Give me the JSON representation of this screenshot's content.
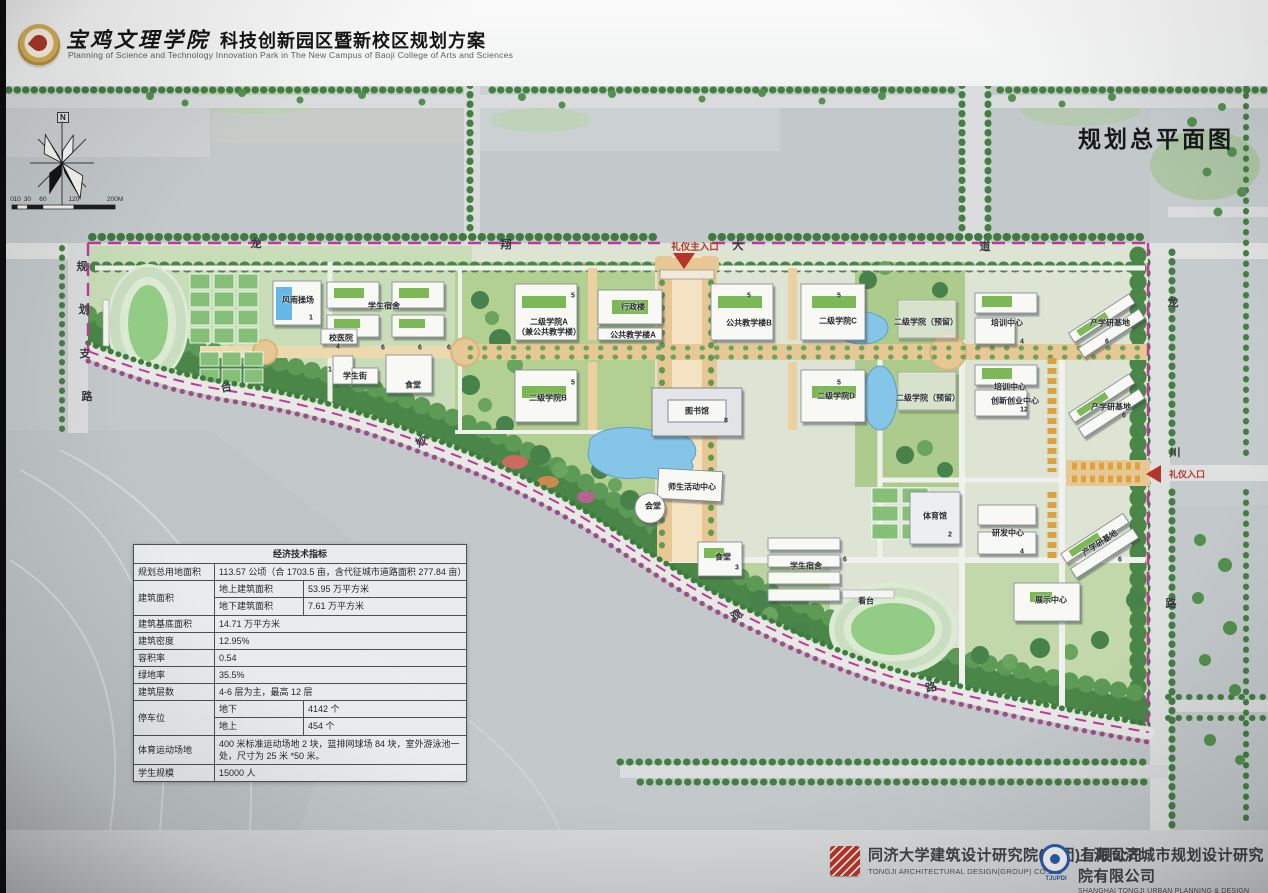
{
  "header": {
    "college_name": "宝鸡文理学院",
    "plan_title": "科技创新园区暨新校区规划方案",
    "subtitle_en": "Planning of Science and Technology Innovation Park in The New Campus of Baoji College of Arts and Sciences"
  },
  "map": {
    "title": "规划总平面图",
    "compass_north": "N",
    "scale": {
      "unit_max": 200,
      "ticks": [
        {
          "v": 0,
          "label": "0"
        },
        {
          "v": 10,
          "label": "10"
        },
        {
          "v": 30,
          "label": "30"
        },
        {
          "v": 60,
          "label": "60"
        },
        {
          "v": 120,
          "label": "120"
        },
        {
          "v": 200,
          "label": "200M"
        }
      ]
    },
    "entrances": {
      "main_label": "礼仪主入口",
      "east_label": "礼仪入口"
    },
    "road_chars": [
      {
        "t": "龙",
        "x": 256,
        "y": 243
      },
      {
        "t": "翔",
        "x": 506,
        "y": 244
      },
      {
        "t": "大",
        "x": 738,
        "y": 245
      },
      {
        "t": "道",
        "x": 985,
        "y": 246
      },
      {
        "t": "龙",
        "x": 1173,
        "y": 302
      },
      {
        "t": "川",
        "x": 1175,
        "y": 452
      },
      {
        "t": "路",
        "x": 1171,
        "y": 603
      },
      {
        "t": "规",
        "x": 82,
        "y": 266
      },
      {
        "t": "划",
        "x": 84,
        "y": 309
      },
      {
        "t": "支",
        "x": 85,
        "y": 353
      },
      {
        "t": "路",
        "x": 87,
        "y": 396
      },
      {
        "t": "台",
        "x": 226,
        "y": 387,
        "r": -12
      },
      {
        "t": "妙",
        "x": 421,
        "y": 441,
        "r": -30
      },
      {
        "t": "观",
        "x": 736,
        "y": 615,
        "r": -25
      },
      {
        "t": "路",
        "x": 931,
        "y": 687,
        "r": -15
      }
    ],
    "labels": [
      {
        "t": "风雨操场",
        "x": 298,
        "y": 300
      },
      {
        "t": "学生宿舍",
        "x": 384,
        "y": 306
      },
      {
        "t": "校医院",
        "x": 341,
        "y": 338
      },
      {
        "t": "学生街",
        "x": 355,
        "y": 376
      },
      {
        "t": "食堂",
        "x": 413,
        "y": 385
      },
      {
        "t": "二级学院A",
        "x": 549,
        "y": 322
      },
      {
        "t": "（兼公共教学楼）",
        "x": 549,
        "y": 332
      },
      {
        "t": "行政楼",
        "x": 633,
        "y": 307
      },
      {
        "t": "公共教学楼A",
        "x": 633,
        "y": 335
      },
      {
        "t": "公共教学楼B",
        "x": 749,
        "y": 323
      },
      {
        "t": "二级学院C",
        "x": 838,
        "y": 321
      },
      {
        "t": "二级学院B",
        "x": 548,
        "y": 398
      },
      {
        "t": "二级学院D",
        "x": 836,
        "y": 396
      },
      {
        "t": "图书馆",
        "x": 697,
        "y": 411
      },
      {
        "t": "二级学院（预留）",
        "x": 926,
        "y": 322
      },
      {
        "t": "二级学院（预留）",
        "x": 928,
        "y": 398
      },
      {
        "t": "培训中心",
        "x": 1007,
        "y": 323
      },
      {
        "t": "培训中心",
        "x": 1010,
        "y": 387
      },
      {
        "t": "创新创业中心",
        "x": 1015,
        "y": 401
      },
      {
        "t": "产学研基地",
        "x": 1110,
        "y": 323
      },
      {
        "t": "产学研基地",
        "x": 1111,
        "y": 407
      },
      {
        "t": "师生活动中心",
        "x": 692,
        "y": 487
      },
      {
        "t": "会堂",
        "x": 653,
        "y": 506
      },
      {
        "t": "食堂",
        "x": 723,
        "y": 557
      },
      {
        "t": "学生宿舍",
        "x": 806,
        "y": 566
      },
      {
        "t": "体育馆",
        "x": 935,
        "y": 516
      },
      {
        "t": "看台",
        "x": 866,
        "y": 601
      },
      {
        "t": "研发中心",
        "x": 1008,
        "y": 533
      },
      {
        "t": "产学研基地",
        "x": 1100,
        "y": 543,
        "r": -33
      },
      {
        "t": "展示中心",
        "x": 1051,
        "y": 600
      }
    ],
    "floor_marks": [
      {
        "t": "1",
        "x": 311,
        "y": 318
      },
      {
        "t": "6",
        "x": 383,
        "y": 348
      },
      {
        "t": "6",
        "x": 420,
        "y": 348
      },
      {
        "t": "6",
        "x": 449,
        "y": 348
      },
      {
        "t": "4",
        "x": 338,
        "y": 347
      },
      {
        "t": "1",
        "x": 330,
        "y": 370
      },
      {
        "t": "5",
        "x": 573,
        "y": 296
      },
      {
        "t": "5",
        "x": 749,
        "y": 296
      },
      {
        "t": "5",
        "x": 839,
        "y": 296
      },
      {
        "t": "5",
        "x": 573,
        "y": 383
      },
      {
        "t": "5",
        "x": 839,
        "y": 383
      },
      {
        "t": "8",
        "x": 726,
        "y": 421
      },
      {
        "t": "3",
        "x": 737,
        "y": 568
      },
      {
        "t": "6",
        "x": 845,
        "y": 560
      },
      {
        "t": "2",
        "x": 950,
        "y": 535
      },
      {
        "t": "4",
        "x": 1022,
        "y": 342
      },
      {
        "t": "12",
        "x": 1024,
        "y": 410
      },
      {
        "t": "6",
        "x": 1107,
        "y": 342
      },
      {
        "t": "6",
        "x": 1124,
        "y": 416
      },
      {
        "t": "4",
        "x": 1022,
        "y": 552
      },
      {
        "t": "6",
        "x": 1120,
        "y": 560
      }
    ]
  },
  "table": {
    "title": "经济技术指标",
    "land_label": "规划总用地面积",
    "land_value": "113.57 公顷（合 1703.5 亩，含代征城市道路面积 277.84 亩）",
    "gfa_label": "建筑面积",
    "gfa_above_label": "地上建筑面积",
    "gfa_above_value": "53.95 万平方米",
    "gfa_below_label": "地下建筑面积",
    "gfa_below_value": "7.61 万平方米",
    "footprint_label": "建筑基底面积",
    "footprint_value": "14.71 万平方米",
    "density_label": "建筑密度",
    "density_value": "12.95%",
    "far_label": "容积率",
    "far_value": "0.54",
    "green_label": "绿地率",
    "green_value": "35.5%",
    "floors_label": "建筑层数",
    "floors_value": "4-6 层为主，最高 12 层",
    "parking_label": "停车位",
    "parking_below_label": "地下",
    "parking_below_value": "4142 个",
    "parking_above_label": "地上",
    "parking_above_value": "454 个",
    "sports_label": "体育运动场地",
    "sports_value": "400 米标准运动场地 2 块，篮排网球场 84 块，室外游泳池一处，尺寸为 25 米 *50 米。",
    "students_label": "学生规模",
    "students_value": "15000 人"
  },
  "footer": {
    "firm1_cn": "同济大学建筑设计研究院(集团)有限公司",
    "firm1_en": "TONGJI ARCHITECTURAL DESIGN(GROUP) CO.LTD",
    "firm2_cn": "上海同济城市规划设计研究院有限公司",
    "firm2_en": "SHANGHAI TONGJI URBAN PLANNING & DESIGN INSTITUTE CO., LTD.",
    "firm2_abbr": "TJUPDI"
  },
  "colors": {
    "boundary_magenta": "#bd3a9c",
    "entrance_red": "#b5342c",
    "water_blue": "#85c5e8",
    "forest_green": "#4a8647",
    "axis_tan": "#e7c793"
  }
}
